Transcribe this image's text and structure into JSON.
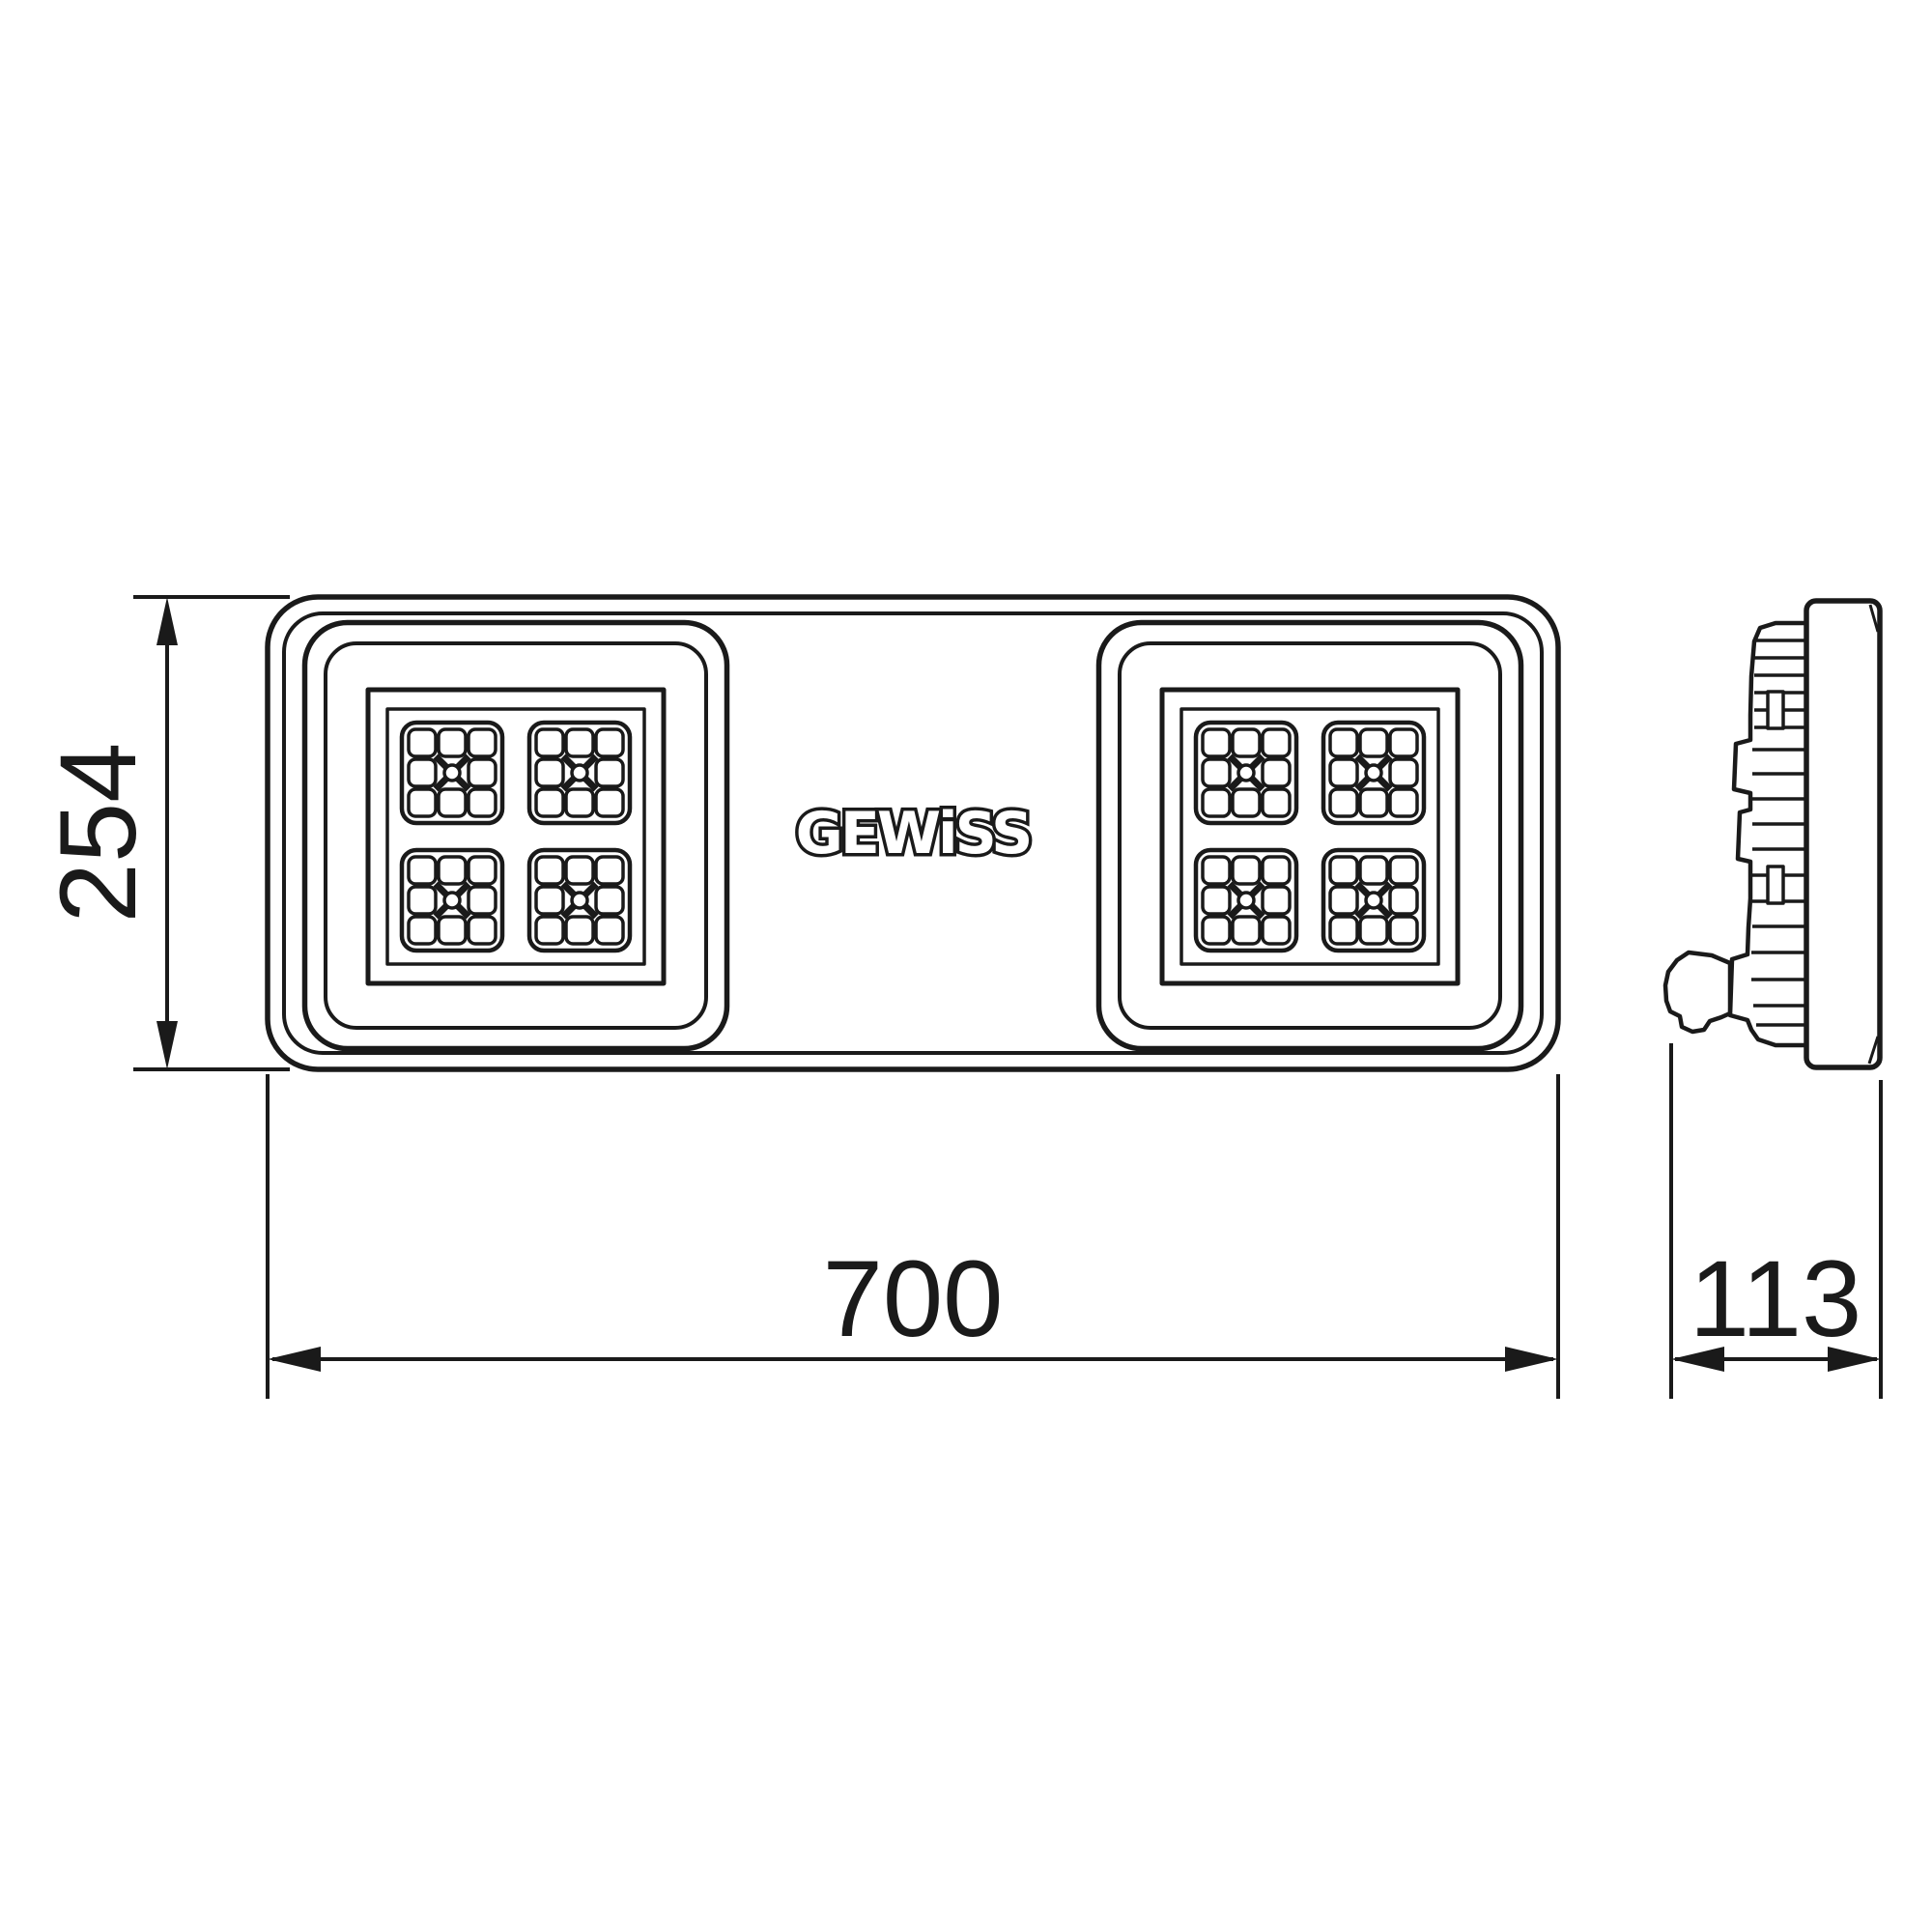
{
  "page": {
    "background": "#ffffff",
    "line_color": "#1a1a1a"
  },
  "logo": {
    "text": "GEWiSS"
  },
  "dimensions": {
    "height": "254",
    "width": "700",
    "depth": "113"
  }
}
